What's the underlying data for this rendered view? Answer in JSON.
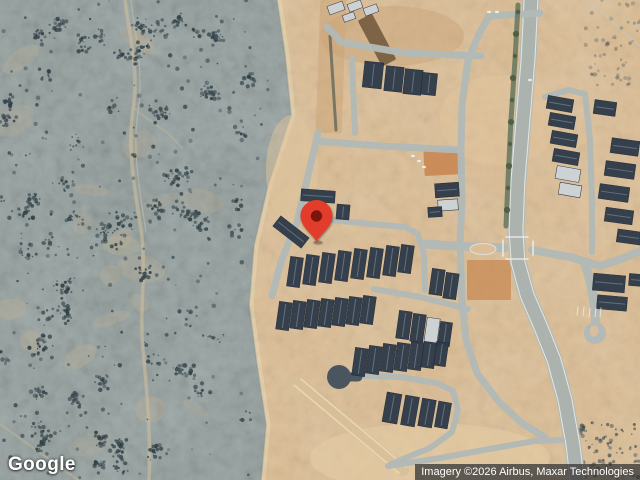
{
  "branding": {
    "logo_text": "Google"
  },
  "attribution": {
    "text": "Imagery ©2026 Airbus, Maxar Technologies"
  },
  "map": {
    "marker": {
      "x": 316.5,
      "y": 242,
      "color": "#E23D2B",
      "dot_color": "#7C150C"
    },
    "palette": {
      "desert": "#9AA5A3",
      "desert_tan": "#C3B295",
      "shrub": "#3C4B52",
      "shrub_dark": "#2E3E45",
      "sand": "#DCBF98",
      "sand_light": "#EADBB6",
      "road": "#B2B9B6",
      "road_dark": "#A9B0AD",
      "road_edge": "#F0F2EE",
      "roof": "#2F3B49",
      "roof_light": "#CDD3D8",
      "roof_ridge": "#8FA0AE",
      "median": "#6B7A62",
      "tree": "#4E5D45",
      "paved_dark": "#4A5560"
    },
    "desert": {
      "boundary": [
        [
          277,
          0
        ],
        [
          285,
          55
        ],
        [
          291,
          115
        ],
        [
          268,
          185
        ],
        [
          254,
          245
        ],
        [
          249,
          305
        ],
        [
          257,
          365
        ],
        [
          266,
          425
        ],
        [
          261,
          480
        ]
      ],
      "seed": 11,
      "clusters": 70,
      "sparse": 260,
      "tan_patches": 22
    },
    "shrub_regions": [
      {
        "box": [
          572,
          640,
          422,
          480
        ],
        "n": 95,
        "o": 0.7
      },
      {
        "box": [
          585,
          640,
          0,
          85
        ],
        "n": 55,
        "o": 0.4
      }
    ],
    "tracks": [
      {
        "d": "M125,0 C130,40 139,70 133,110 C127,150 135,190 141,230 C147,270 139,310 143,350 C147,390 151,440 149,480",
        "w": 3.5,
        "c": "#CDBD9E",
        "o": 0.6
      },
      {
        "d": "M131,0 C136,40 144,72 138,112 C132,152 140,192 146,232",
        "w": 1.2,
        "c": "#D6C8A8",
        "o": 0.45
      },
      {
        "d": "M0,424 L78,480",
        "w": 2.5,
        "c": "#C9BA9C",
        "o": 0.4
      },
      {
        "d": "M134,108 C152,124 168,130 182,148",
        "w": 2,
        "c": "#C9BA9C",
        "o": 0.35
      },
      {
        "d": "M588,0 L640,46",
        "w": 2,
        "c": "#C2C9C4",
        "o": 0.5
      },
      {
        "d": "M604,0 L640,28",
        "w": 1.5,
        "c": "#C2C9C4",
        "o": 0.4
      }
    ],
    "under_marks": [
      {
        "d": "M297,382 L403,470",
        "w": 12,
        "c": "#D6BF99",
        "o": 0.9
      },
      {
        "d": "M294,385 L399,473",
        "w": 1.5,
        "c": "#EADAB4",
        "o": 0.9
      },
      {
        "d": "M301,379 L406,467",
        "w": 1.5,
        "c": "#EADAB4",
        "o": 0.9
      },
      {
        "d": "M330,36 L336,130",
        "w": 3,
        "c": "#5E6157",
        "o": 0.75
      }
    ],
    "patches": [
      {
        "cx": 430,
        "cy": 458,
        "rx": 120,
        "ry": 35,
        "c": "#E5CEA6",
        "o": 0.55
      },
      {
        "cx": 392,
        "cy": 36,
        "rx": 72,
        "ry": 30,
        "c": "#C9A172",
        "o": 0.4
      },
      {
        "cx": 292,
        "cy": 170,
        "rx": 26,
        "ry": 55,
        "c": "#DFC59D",
        "o": 0.5
      },
      {
        "cx": 500,
        "cy": 120,
        "rx": 60,
        "ry": 45,
        "c": "#E2C69E",
        "o": 0.45
      }
    ],
    "parcels": [
      {
        "cx": 444,
        "cy": 162,
        "w": 40,
        "h": 26,
        "rot": -3,
        "c": "#C8854F",
        "o": 0.85
      },
      {
        "cx": 489,
        "cy": 280,
        "w": 44,
        "h": 40,
        "rot": 0,
        "c": "#C98D57",
        "o": 0.8
      },
      {
        "cx": 331,
        "cy": 66,
        "w": 26,
        "h": 134,
        "rot": 2,
        "c": "#C9A273",
        "o": 0.45
      },
      {
        "cx": 377,
        "cy": 40,
        "w": 16,
        "h": 52,
        "rot": -28,
        "c": "#6E563B",
        "o": 0.85
      }
    ],
    "main_road": {
      "pts": [
        [
          531,
          0
        ],
        [
          528,
          60
        ],
        [
          523,
          120
        ],
        [
          518,
          180
        ],
        [
          516,
          230
        ],
        [
          518,
          262
        ],
        [
          527,
          295
        ],
        [
          540,
          325
        ],
        [
          554,
          360
        ],
        [
          565,
          400
        ],
        [
          573,
          445
        ],
        [
          577,
          480
        ]
      ],
      "w": 17
    },
    "roads": [
      {
        "pts": [
          [
            327,
            27
          ],
          [
            341,
            42
          ],
          [
            404,
            53
          ],
          [
            481,
            56
          ]
        ],
        "w": 7
      },
      {
        "pts": [
          [
            540,
            13
          ],
          [
            489,
            16
          ],
          [
            479,
            34
          ],
          [
            468,
            60
          ],
          [
            462,
            105
          ],
          [
            461,
            150
          ]
        ],
        "w": 7
      },
      {
        "pts": [
          [
            316,
            141
          ],
          [
            380,
            146
          ],
          [
            461,
            150
          ]
        ],
        "w": 7
      },
      {
        "pts": [
          [
            352,
            58
          ],
          [
            355,
            133
          ]
        ],
        "w": 6
      },
      {
        "pts": [
          [
            318,
            133
          ],
          [
            307,
            180
          ],
          [
            297,
            222
          ],
          [
            281,
            262
          ],
          [
            272,
            296
          ]
        ],
        "w": 7
      },
      {
        "pts": [
          [
            305,
            217
          ],
          [
            360,
            223
          ],
          [
            405,
            227
          ],
          [
            418,
            234
          ],
          [
            424,
            255
          ],
          [
            425,
            290
          ]
        ],
        "w": 6
      },
      {
        "pts": [
          [
            374,
            289
          ],
          [
            420,
            297
          ],
          [
            468,
            309
          ]
        ],
        "w": 6
      },
      {
        "pts": [
          [
            461,
            150
          ],
          [
            462,
            200
          ],
          [
            460,
            242
          ],
          [
            462,
            300
          ],
          [
            466,
            340
          ],
          [
            477,
            373
          ],
          [
            499,
            402
          ],
          [
            523,
            424
          ],
          [
            545,
            437
          ]
        ],
        "w": 7
      },
      {
        "pts": [
          [
            424,
            244
          ],
          [
            455,
            246
          ],
          [
            504,
            248
          ]
        ],
        "w": 9
      },
      {
        "pts": [
          [
            532,
            250
          ],
          [
            570,
            257
          ],
          [
            600,
            266
          ],
          [
            624,
            258
          ],
          [
            640,
            251
          ]
        ],
        "w": 8
      },
      {
        "pts": [
          [
            545,
            97
          ],
          [
            568,
            90
          ],
          [
            585,
            94
          ],
          [
            590,
            140
          ],
          [
            592,
            200
          ],
          [
            592,
            252
          ]
        ],
        "w": 6
      },
      {
        "pts": [
          [
            585,
            263
          ],
          [
            591,
            285
          ],
          [
            595,
            310
          ],
          [
            596,
            330
          ]
        ],
        "w": 9
      },
      {
        "pts": [
          [
            350,
            375
          ],
          [
            400,
            377
          ],
          [
            437,
            383
          ],
          [
            453,
            391
          ],
          [
            458,
            410
          ],
          [
            452,
            432
          ],
          [
            430,
            448
          ],
          [
            398,
            461
          ],
          [
            388,
            466
          ]
        ],
        "w": 6
      },
      {
        "pts": [
          [
            388,
            466
          ],
          [
            440,
            458
          ],
          [
            495,
            448
          ],
          [
            535,
            441
          ],
          [
            562,
            440
          ]
        ],
        "w": 6
      },
      {
        "pts": [
          [
            348,
            377
          ],
          [
            358,
            377
          ]
        ],
        "w": 9,
        "dark": true
      }
    ],
    "median": {
      "pts": [
        [
          518,
          5
        ],
        [
          515,
          60
        ],
        [
          511,
          120
        ],
        [
          508,
          180
        ],
        [
          506,
          226
        ]
      ],
      "w": 5
    },
    "trees": [
      [
        518,
        12
      ],
      [
        516,
        34
      ],
      [
        515,
        56
      ],
      [
        513,
        78
      ],
      [
        512,
        100
      ],
      [
        511,
        122
      ],
      [
        510,
        144
      ],
      [
        509,
        166
      ],
      [
        508,
        188
      ],
      [
        507,
        210
      ]
    ],
    "island": {
      "cx": 483,
      "cy": 249,
      "rx": 13,
      "ry": 5.5
    },
    "culdesacs": [
      {
        "cx": 339,
        "cy": 377,
        "r": 12,
        "dark": true
      },
      {
        "cx": 595,
        "cy": 333,
        "r": 11
      }
    ],
    "loop_island": {
      "cx": 594,
      "cy": 331,
      "rx": 4.5,
      "ry": 5.5
    },
    "houses": [
      [
        373,
        75,
        19,
        26,
        6
      ],
      [
        394,
        79,
        18,
        25,
        6
      ],
      [
        413,
        82,
        18,
        25,
        6
      ],
      [
        429,
        84,
        15,
        22,
        6
      ],
      [
        318,
        196,
        34,
        12,
        4
      ],
      [
        291,
        232,
        36,
        13,
        38
      ],
      [
        343,
        212,
        13,
        15,
        5
      ],
      [
        447,
        190,
        24,
        14,
        -4
      ],
      [
        448,
        205,
        20,
        11,
        -4,
        1
      ],
      [
        435,
        212,
        14,
        10,
        -4
      ],
      [
        295,
        272,
        13,
        30,
        8
      ],
      [
        311,
        270,
        13,
        30,
        8
      ],
      [
        327,
        268,
        13,
        30,
        8
      ],
      [
        343,
        266,
        13,
        30,
        8
      ],
      [
        359,
        264,
        13,
        30,
        8
      ],
      [
        375,
        263,
        13,
        30,
        8
      ],
      [
        391,
        261,
        13,
        30,
        8
      ],
      [
        406,
        259,
        13,
        28,
        8
      ],
      [
        437,
        282,
        13,
        26,
        8
      ],
      [
        451,
        286,
        13,
        26,
        8
      ],
      [
        284,
        316,
        13,
        28,
        8
      ],
      [
        298,
        315,
        13,
        28,
        8
      ],
      [
        312,
        314,
        13,
        28,
        8
      ],
      [
        326,
        313,
        13,
        28,
        8
      ],
      [
        340,
        312,
        13,
        28,
        8
      ],
      [
        354,
        311,
        13,
        28,
        8
      ],
      [
        368,
        310,
        13,
        28,
        8
      ],
      [
        404,
        325,
        13,
        28,
        8
      ],
      [
        418,
        328,
        13,
        28,
        8
      ],
      [
        432,
        331,
        13,
        26,
        8,
        1
      ],
      [
        445,
        334,
        12,
        24,
        8
      ],
      [
        360,
        362,
        13,
        28,
        8
      ],
      [
        374,
        360,
        13,
        28,
        8
      ],
      [
        388,
        358,
        13,
        28,
        8
      ],
      [
        402,
        357,
        13,
        28,
        8
      ],
      [
        416,
        356,
        13,
        28,
        8
      ],
      [
        429,
        355,
        13,
        26,
        8
      ],
      [
        441,
        354,
        12,
        24,
        8
      ],
      [
        392,
        408,
        15,
        30,
        10
      ],
      [
        410,
        411,
        14,
        30,
        10
      ],
      [
        427,
        413,
        14,
        28,
        10
      ],
      [
        443,
        415,
        13,
        26,
        10
      ],
      [
        560,
        104,
        26,
        13,
        10
      ],
      [
        562,
        121,
        26,
        13,
        10
      ],
      [
        564,
        139,
        26,
        13,
        10
      ],
      [
        566,
        157,
        26,
        13,
        10
      ],
      [
        568,
        174,
        24,
        13,
        10,
        1
      ],
      [
        570,
        190,
        22,
        12,
        10,
        1
      ],
      [
        605,
        108,
        22,
        14,
        8
      ],
      [
        625,
        147,
        28,
        15,
        8
      ],
      [
        620,
        170,
        30,
        15,
        8
      ],
      [
        614,
        193,
        30,
        15,
        8
      ],
      [
        619,
        216,
        28,
        14,
        8
      ],
      [
        629,
        237,
        24,
        13,
        8
      ],
      [
        609,
        283,
        32,
        17,
        5
      ],
      [
        612,
        303,
        30,
        14,
        5
      ],
      [
        636,
        280,
        14,
        12,
        5
      ],
      [
        336,
        8,
        16,
        9,
        -20,
        1
      ],
      [
        355,
        6,
        14,
        8,
        -20,
        1
      ],
      [
        371,
        10,
        14,
        8,
        -20,
        1
      ],
      [
        349,
        17,
        12,
        7,
        -20,
        1
      ]
    ],
    "vehicles": [
      [
        413,
        156
      ],
      [
        419,
        161
      ],
      [
        424,
        167
      ],
      [
        489,
        12
      ],
      [
        497,
        12
      ],
      [
        530,
        80
      ]
    ],
    "over_marks": [
      {
        "d": "M506,237 L528,237",
        "w": 1.6,
        "c": "#EEF0EC",
        "o": 0.85
      },
      {
        "d": "M506,259 L528,259",
        "w": 1.6,
        "c": "#EEF0EC",
        "o": 0.85
      },
      {
        "d": "M503,240 L503,256",
        "w": 1.6,
        "c": "#EEF0EC",
        "o": 0.85
      },
      {
        "d": "M533,241 L533,255",
        "w": 1.6,
        "c": "#EEF0EC",
        "o": 0.85
      },
      {
        "d": "M578,306 L577,315",
        "w": 1,
        "c": "#E8EAE6",
        "o": 0.85
      },
      {
        "d": "M584,307 L583,316",
        "w": 1,
        "c": "#E8EAE6",
        "o": 0.85
      },
      {
        "d": "M590,308 L589,317",
        "w": 1,
        "c": "#E8EAE6",
        "o": 0.85
      },
      {
        "d": "M596,308 L595,317",
        "w": 1,
        "c": "#E8EAE6",
        "o": 0.85
      },
      {
        "d": "M601,308 L600,317",
        "w": 1,
        "c": "#E8EAE6",
        "o": 0.85
      }
    ]
  }
}
